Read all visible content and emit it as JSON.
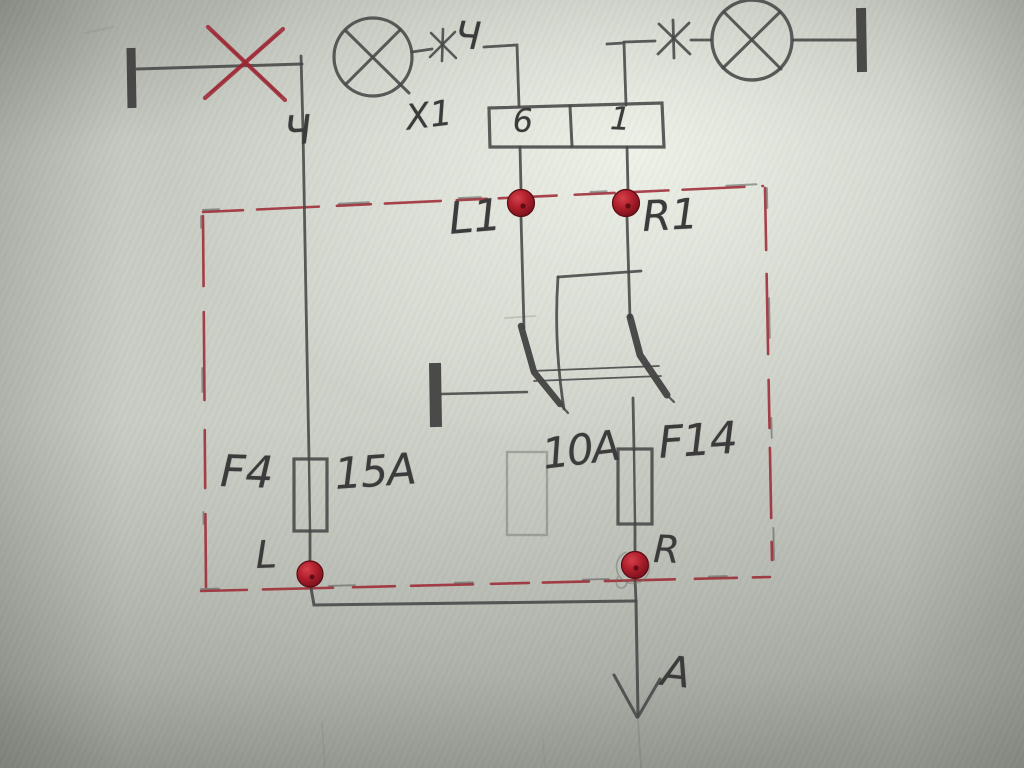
{
  "colors": {
    "paper": "#c6cac2",
    "pencil": "#454545",
    "red_marker": "#9c2631",
    "terminal_dot_red": "#b01f2c"
  },
  "schematic": {
    "wire_label": "Ч",
    "left_lamp_mark": "Ч",
    "connector": {
      "label": "X1",
      "pins": [
        "6",
        "1"
      ]
    },
    "terminals": {
      "top_left": "L1",
      "top_right": "R1",
      "bottom_left": "L",
      "bottom_right": "R"
    },
    "fuse_left": {
      "name": "F4",
      "rating": "15A"
    },
    "fuse_right": {
      "name": "F14",
      "rating": "10A"
    },
    "output_arrow": "A"
  }
}
